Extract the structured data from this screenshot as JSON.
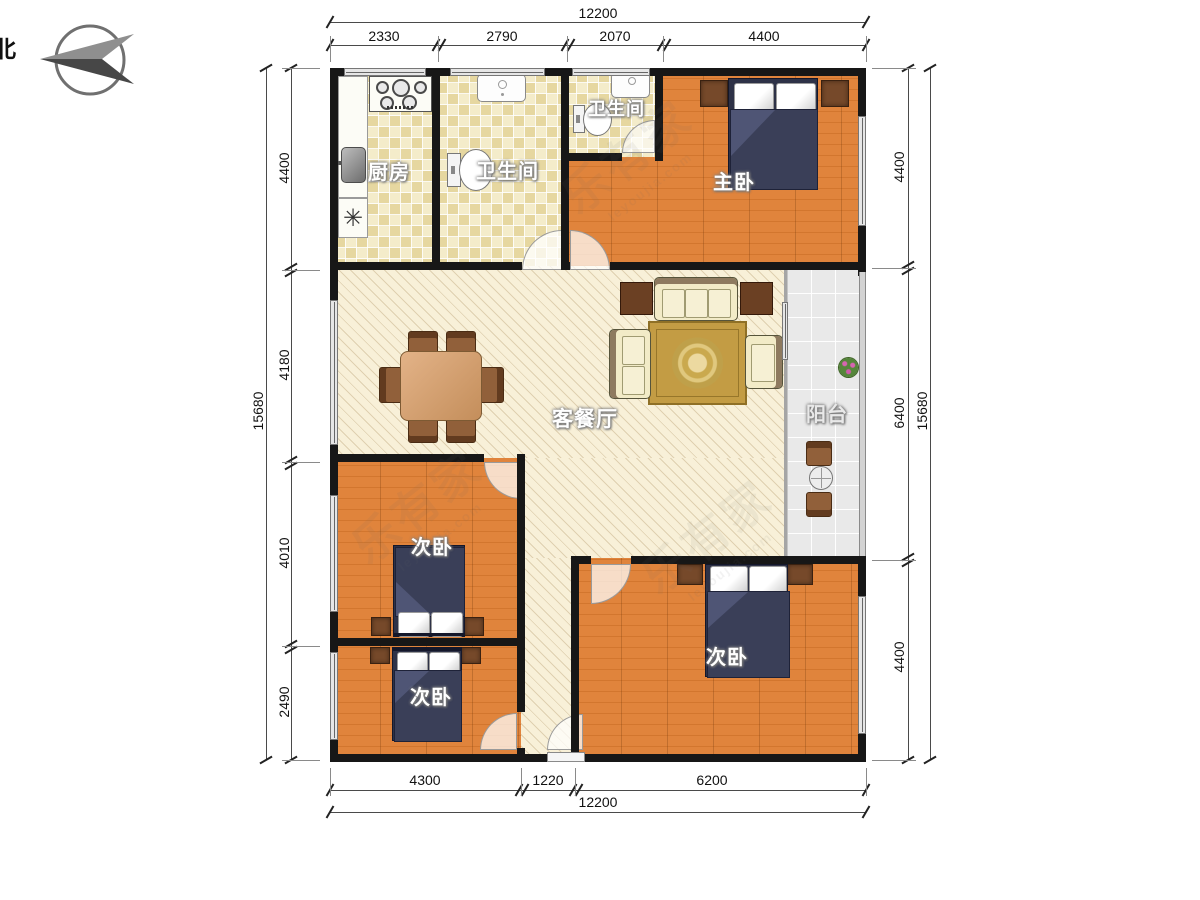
{
  "compass": {
    "north": "北"
  },
  "rooms": {
    "kitchen": "厨房",
    "bathroom_main": "卫生间",
    "bathroom_small": "卫生间",
    "master_bedroom": "主卧",
    "living_dining": "客餐厅",
    "balcony": "阳台",
    "bedroom_left_upper": "次卧",
    "bedroom_left_lower": "次卧",
    "bedroom_right": "次卧"
  },
  "symbols": {
    "floor_drain": "✳"
  },
  "dimensions": {
    "top_total": "12200",
    "top_segments": [
      "2330",
      "2790",
      "2070",
      "4400"
    ],
    "left_total": "15680",
    "left_segments": [
      "4400",
      "4180",
      "4010",
      "2490"
    ],
    "right_total": "15680",
    "right_segments": [
      "4400",
      "6400",
      "4400"
    ],
    "bottom_total": "12200",
    "bottom_segments": [
      "4300",
      "1220",
      "6200"
    ]
  },
  "watermark": {
    "brand": "乐有家",
    "domain": "leyoujia.com"
  }
}
